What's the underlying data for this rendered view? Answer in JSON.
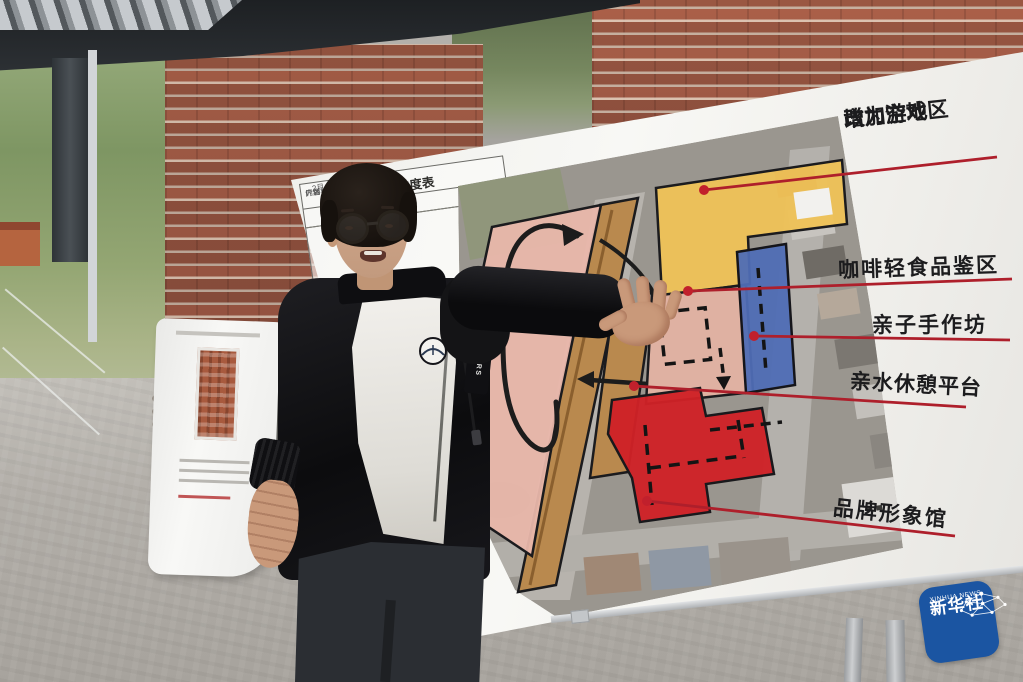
{
  "board": {
    "schedule_table": {
      "title": "倒排进度表",
      "rows": [
        {
          "c1": "",
          "c2": "内容"
        },
        {
          "c1": "2月",
          "c2": "厂房相关条件"
        },
        {
          "c1": "",
          "c2": "计划，须达企业"
        }
      ]
    },
    "annotations": {
      "a1_line1": "改为空地",
      "a1_line2": "增加游戏区",
      "a2": "咖啡轻食品鉴区",
      "a3": "亲子手作坊",
      "a4": "亲水休憩平台",
      "a5": "品牌形象馆"
    },
    "annotation_color": "#ae1f2b",
    "zones": {
      "pink_large": "#e9b7ab",
      "walkway_tan": "#b9894e",
      "game_yellow": "#eec257",
      "coffee_pink": "#e3b2a3",
      "handcraft_blue": "#4f6db5",
      "brand_red": "#cf2127"
    }
  },
  "presenter": {
    "jacket_brand": "WARRIORS"
  },
  "watermark": {
    "cn": "新华社",
    "en": "XINHUA NEWS",
    "bg": "#1b55a2"
  }
}
